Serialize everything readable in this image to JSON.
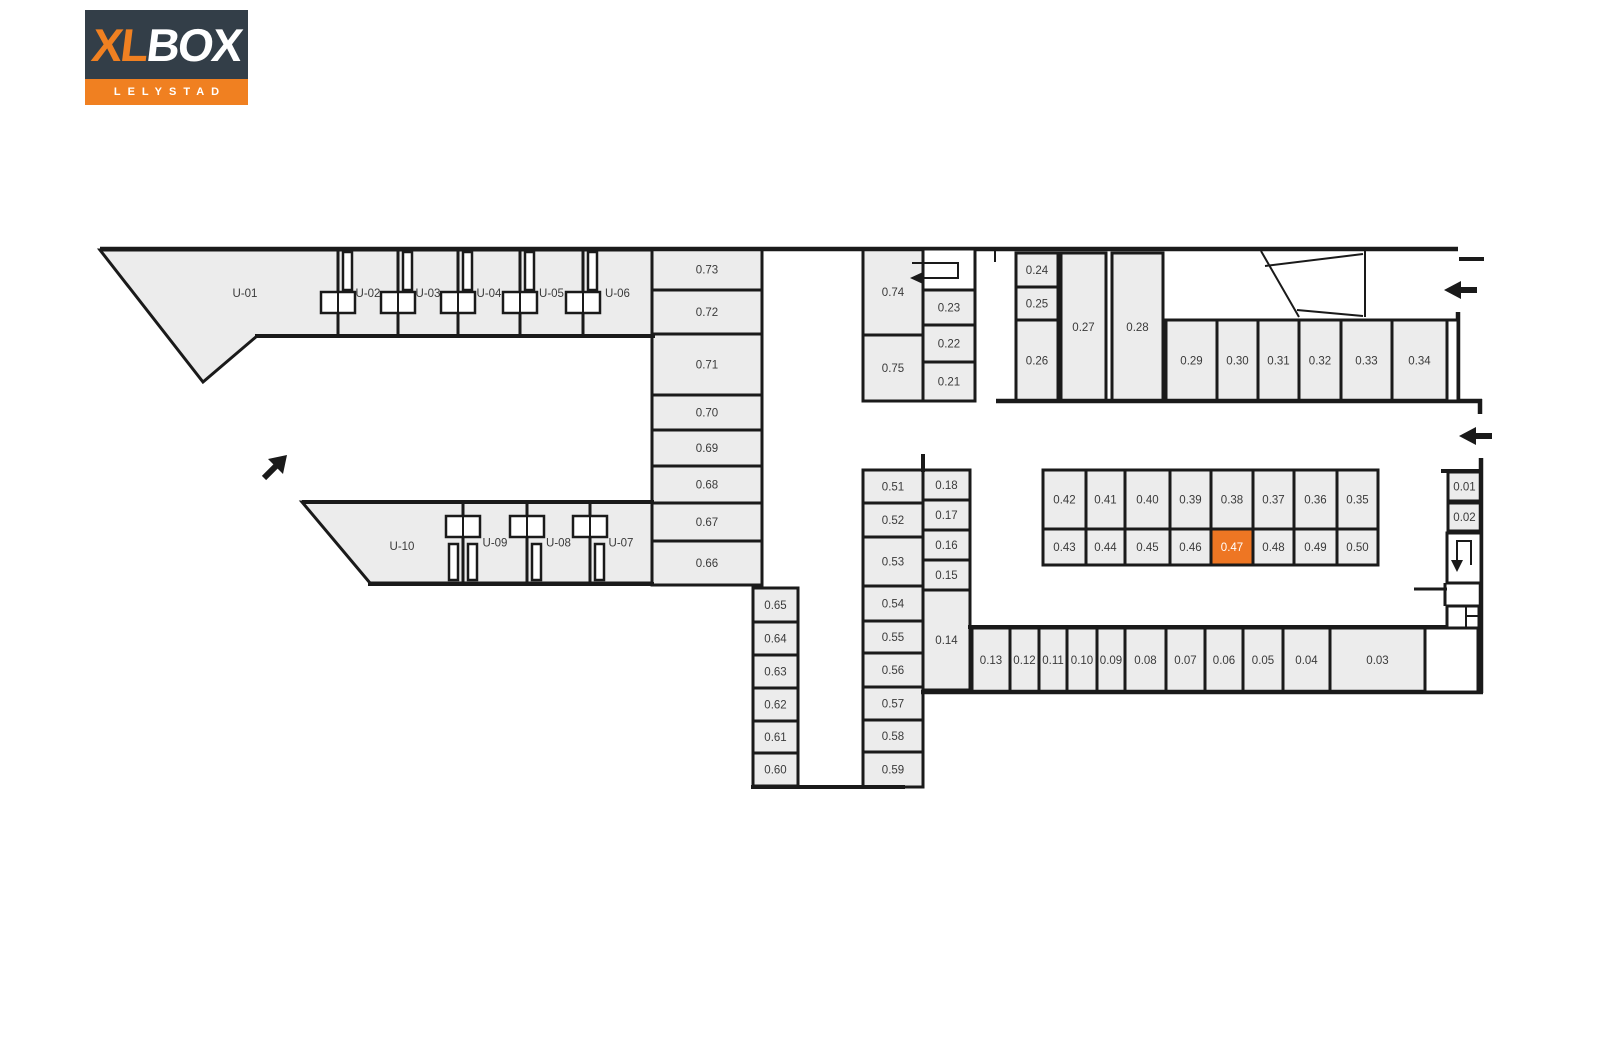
{
  "logo": {
    "xl": "XL",
    "box": "BOX",
    "location": "LELYSTAD"
  },
  "colors": {
    "unit_fill": "#ececec",
    "wall": "#1a1a1a",
    "highlight_orange": "#ee7623",
    "logo_navy": "#333e48",
    "logo_orange": "#f08021",
    "label_text": "#3a3a3a"
  },
  "highlighted_unit": "0.47",
  "units": [
    {
      "id": "U-01",
      "points": "100,250 338,250 338,336 257,336 203,382",
      "lx": 245,
      "ly": 293
    },
    {
      "id": "U-02",
      "x": 338,
      "y": 250,
      "w": 60,
      "h": 86
    },
    {
      "id": "U-03",
      "x": 398,
      "y": 250,
      "w": 60,
      "h": 86
    },
    {
      "id": "U-04",
      "x": 458,
      "y": 250,
      "w": 62,
      "h": 86
    },
    {
      "id": "U-05",
      "x": 520,
      "y": 250,
      "w": 63,
      "h": 86
    },
    {
      "id": "U-06",
      "x": 583,
      "y": 250,
      "w": 69,
      "h": 86
    },
    {
      "id": "0.73",
      "x": 652,
      "y": 249,
      "w": 110,
      "h": 41
    },
    {
      "id": "0.72",
      "x": 652,
      "y": 290,
      "w": 110,
      "h": 44
    },
    {
      "id": "0.71",
      "x": 652,
      "y": 334,
      "w": 110,
      "h": 61
    },
    {
      "id": "0.70",
      "x": 652,
      "y": 395,
      "w": 110,
      "h": 35
    },
    {
      "id": "0.69",
      "x": 652,
      "y": 430,
      "w": 110,
      "h": 36
    },
    {
      "id": "0.68",
      "x": 652,
      "y": 466,
      "w": 110,
      "h": 37
    },
    {
      "id": "0.67",
      "x": 652,
      "y": 503,
      "w": 110,
      "h": 38
    },
    {
      "id": "0.66",
      "x": 652,
      "y": 541,
      "w": 110,
      "h": 44
    },
    {
      "id": "0.74",
      "x": 863,
      "y": 249,
      "w": 60,
      "h": 86
    },
    {
      "id": "0.75",
      "x": 863,
      "y": 335,
      "w": 60,
      "h": 66
    },
    {
      "id": "0.23",
      "x": 923,
      "y": 290,
      "w": 52,
      "h": 35
    },
    {
      "id": "0.22",
      "x": 923,
      "y": 325,
      "w": 52,
      "h": 37
    },
    {
      "id": "0.21",
      "x": 923,
      "y": 362,
      "w": 52,
      "h": 39
    },
    {
      "id": "0.24",
      "x": 1016,
      "y": 253,
      "w": 42,
      "h": 34
    },
    {
      "id": "0.25",
      "x": 1016,
      "y": 287,
      "w": 42,
      "h": 33
    },
    {
      "id": "0.26",
      "x": 1016,
      "y": 320,
      "w": 42,
      "h": 81
    },
    {
      "id": "0.27",
      "x": 1061,
      "y": 253,
      "w": 45,
      "h": 148
    },
    {
      "id": "0.28",
      "x": 1112,
      "y": 253,
      "w": 51,
      "h": 148
    },
    {
      "id": "0.29",
      "x": 1166,
      "y": 320,
      "w": 51,
      "h": 81
    },
    {
      "id": "0.30",
      "x": 1217,
      "y": 320,
      "w": 41,
      "h": 81
    },
    {
      "id": "0.31",
      "x": 1258,
      "y": 320,
      "w": 41,
      "h": 81
    },
    {
      "id": "0.32",
      "x": 1299,
      "y": 320,
      "w": 42,
      "h": 81
    },
    {
      "id": "0.33",
      "x": 1341,
      "y": 320,
      "w": 51,
      "h": 81
    },
    {
      "id": "0.34",
      "x": 1392,
      "y": 320,
      "w": 55,
      "h": 81
    },
    {
      "id": "0.42",
      "x": 1043,
      "y": 470,
      "w": 43,
      "h": 59
    },
    {
      "id": "0.41",
      "x": 1086,
      "y": 470,
      "w": 39,
      "h": 59
    },
    {
      "id": "0.40",
      "x": 1125,
      "y": 470,
      "w": 45,
      "h": 59
    },
    {
      "id": "0.39",
      "x": 1170,
      "y": 470,
      "w": 41,
      "h": 59
    },
    {
      "id": "0.38",
      "x": 1211,
      "y": 470,
      "w": 42,
      "h": 59
    },
    {
      "id": "0.37",
      "x": 1253,
      "y": 470,
      "w": 41,
      "h": 59
    },
    {
      "id": "0.36",
      "x": 1294,
      "y": 470,
      "w": 43,
      "h": 59
    },
    {
      "id": "0.35",
      "x": 1337,
      "y": 470,
      "w": 41,
      "h": 59
    },
    {
      "id": "0.43",
      "x": 1043,
      "y": 529,
      "w": 43,
      "h": 36
    },
    {
      "id": "0.44",
      "x": 1086,
      "y": 529,
      "w": 39,
      "h": 36
    },
    {
      "id": "0.45",
      "x": 1125,
      "y": 529,
      "w": 45,
      "h": 36
    },
    {
      "id": "0.46",
      "x": 1170,
      "y": 529,
      "w": 41,
      "h": 36
    },
    {
      "id": "0.47",
      "x": 1211,
      "y": 529,
      "w": 42,
      "h": 36
    },
    {
      "id": "0.48",
      "x": 1253,
      "y": 529,
      "w": 41,
      "h": 36
    },
    {
      "id": "0.49",
      "x": 1294,
      "y": 529,
      "w": 43,
      "h": 36
    },
    {
      "id": "0.50",
      "x": 1337,
      "y": 529,
      "w": 41,
      "h": 36
    },
    {
      "id": "0.01",
      "x": 1448,
      "y": 472,
      "w": 33,
      "h": 29
    },
    {
      "id": "0.02",
      "x": 1448,
      "y": 503,
      "w": 33,
      "h": 28
    },
    {
      "id": "0.51",
      "x": 863,
      "y": 470,
      "w": 60,
      "h": 33
    },
    {
      "id": "0.52",
      "x": 863,
      "y": 503,
      "w": 60,
      "h": 34
    },
    {
      "id": "0.53",
      "x": 863,
      "y": 537,
      "w": 60,
      "h": 49
    },
    {
      "id": "0.54",
      "x": 863,
      "y": 586,
      "w": 60,
      "h": 35
    },
    {
      "id": "0.55",
      "x": 863,
      "y": 621,
      "w": 60,
      "h": 32
    },
    {
      "id": "0.56",
      "x": 863,
      "y": 653,
      "w": 60,
      "h": 34
    },
    {
      "id": "0.57",
      "x": 863,
      "y": 687,
      "w": 60,
      "h": 33
    },
    {
      "id": "0.58",
      "x": 863,
      "y": 720,
      "w": 60,
      "h": 32
    },
    {
      "id": "0.59",
      "x": 863,
      "y": 752,
      "w": 60,
      "h": 35
    },
    {
      "id": "0.18",
      "x": 923,
      "y": 470,
      "w": 47,
      "h": 30
    },
    {
      "id": "0.17",
      "x": 923,
      "y": 500,
      "w": 47,
      "h": 30
    },
    {
      "id": "0.16",
      "x": 923,
      "y": 530,
      "w": 47,
      "h": 30
    },
    {
      "id": "0.15",
      "x": 923,
      "y": 560,
      "w": 47,
      "h": 30
    },
    {
      "id": "0.14",
      "x": 923,
      "y": 590,
      "w": 47,
      "h": 100
    },
    {
      "id": "0.65",
      "x": 753,
      "y": 588,
      "w": 45,
      "h": 34
    },
    {
      "id": "0.64",
      "x": 753,
      "y": 622,
      "w": 45,
      "h": 33
    },
    {
      "id": "0.63",
      "x": 753,
      "y": 655,
      "w": 45,
      "h": 33
    },
    {
      "id": "0.62",
      "x": 753,
      "y": 688,
      "w": 45,
      "h": 33
    },
    {
      "id": "0.61",
      "x": 753,
      "y": 721,
      "w": 45,
      "h": 32
    },
    {
      "id": "0.60",
      "x": 753,
      "y": 753,
      "w": 45,
      "h": 33
    },
    {
      "id": "U-10",
      "points": "302,502 463,502 463,583 370,583",
      "lx": 402,
      "ly": 546
    },
    {
      "id": "U-09",
      "x": 463,
      "y": 502,
      "w": 64,
      "h": 81
    },
    {
      "id": "U-08",
      "x": 527,
      "y": 502,
      "w": 63,
      "h": 81
    },
    {
      "id": "U-07",
      "x": 590,
      "y": 502,
      "w": 62,
      "h": 81
    },
    {
      "id": "0.13",
      "x": 972,
      "y": 628,
      "w": 38,
      "h": 64
    },
    {
      "id": "0.12",
      "x": 1010,
      "y": 628,
      "w": 29,
      "h": 64
    },
    {
      "id": "0.11",
      "x": 1039,
      "y": 628,
      "w": 28,
      "h": 64
    },
    {
      "id": "0.10",
      "x": 1067,
      "y": 628,
      "w": 30,
      "h": 64
    },
    {
      "id": "0.09",
      "x": 1097,
      "y": 628,
      "w": 28,
      "h": 64
    },
    {
      "id": "0.08",
      "x": 1125,
      "y": 628,
      "w": 41,
      "h": 64
    },
    {
      "id": "0.07",
      "x": 1166,
      "y": 628,
      "w": 39,
      "h": 64
    },
    {
      "id": "0.06",
      "x": 1205,
      "y": 628,
      "w": 38,
      "h": 64
    },
    {
      "id": "0.05",
      "x": 1243,
      "y": 628,
      "w": 40,
      "h": 64
    },
    {
      "id": "0.04",
      "x": 1283,
      "y": 628,
      "w": 47,
      "h": 64
    },
    {
      "id": "0.03",
      "x": 1330,
      "y": 628,
      "w": 95,
      "h": 64
    }
  ]
}
